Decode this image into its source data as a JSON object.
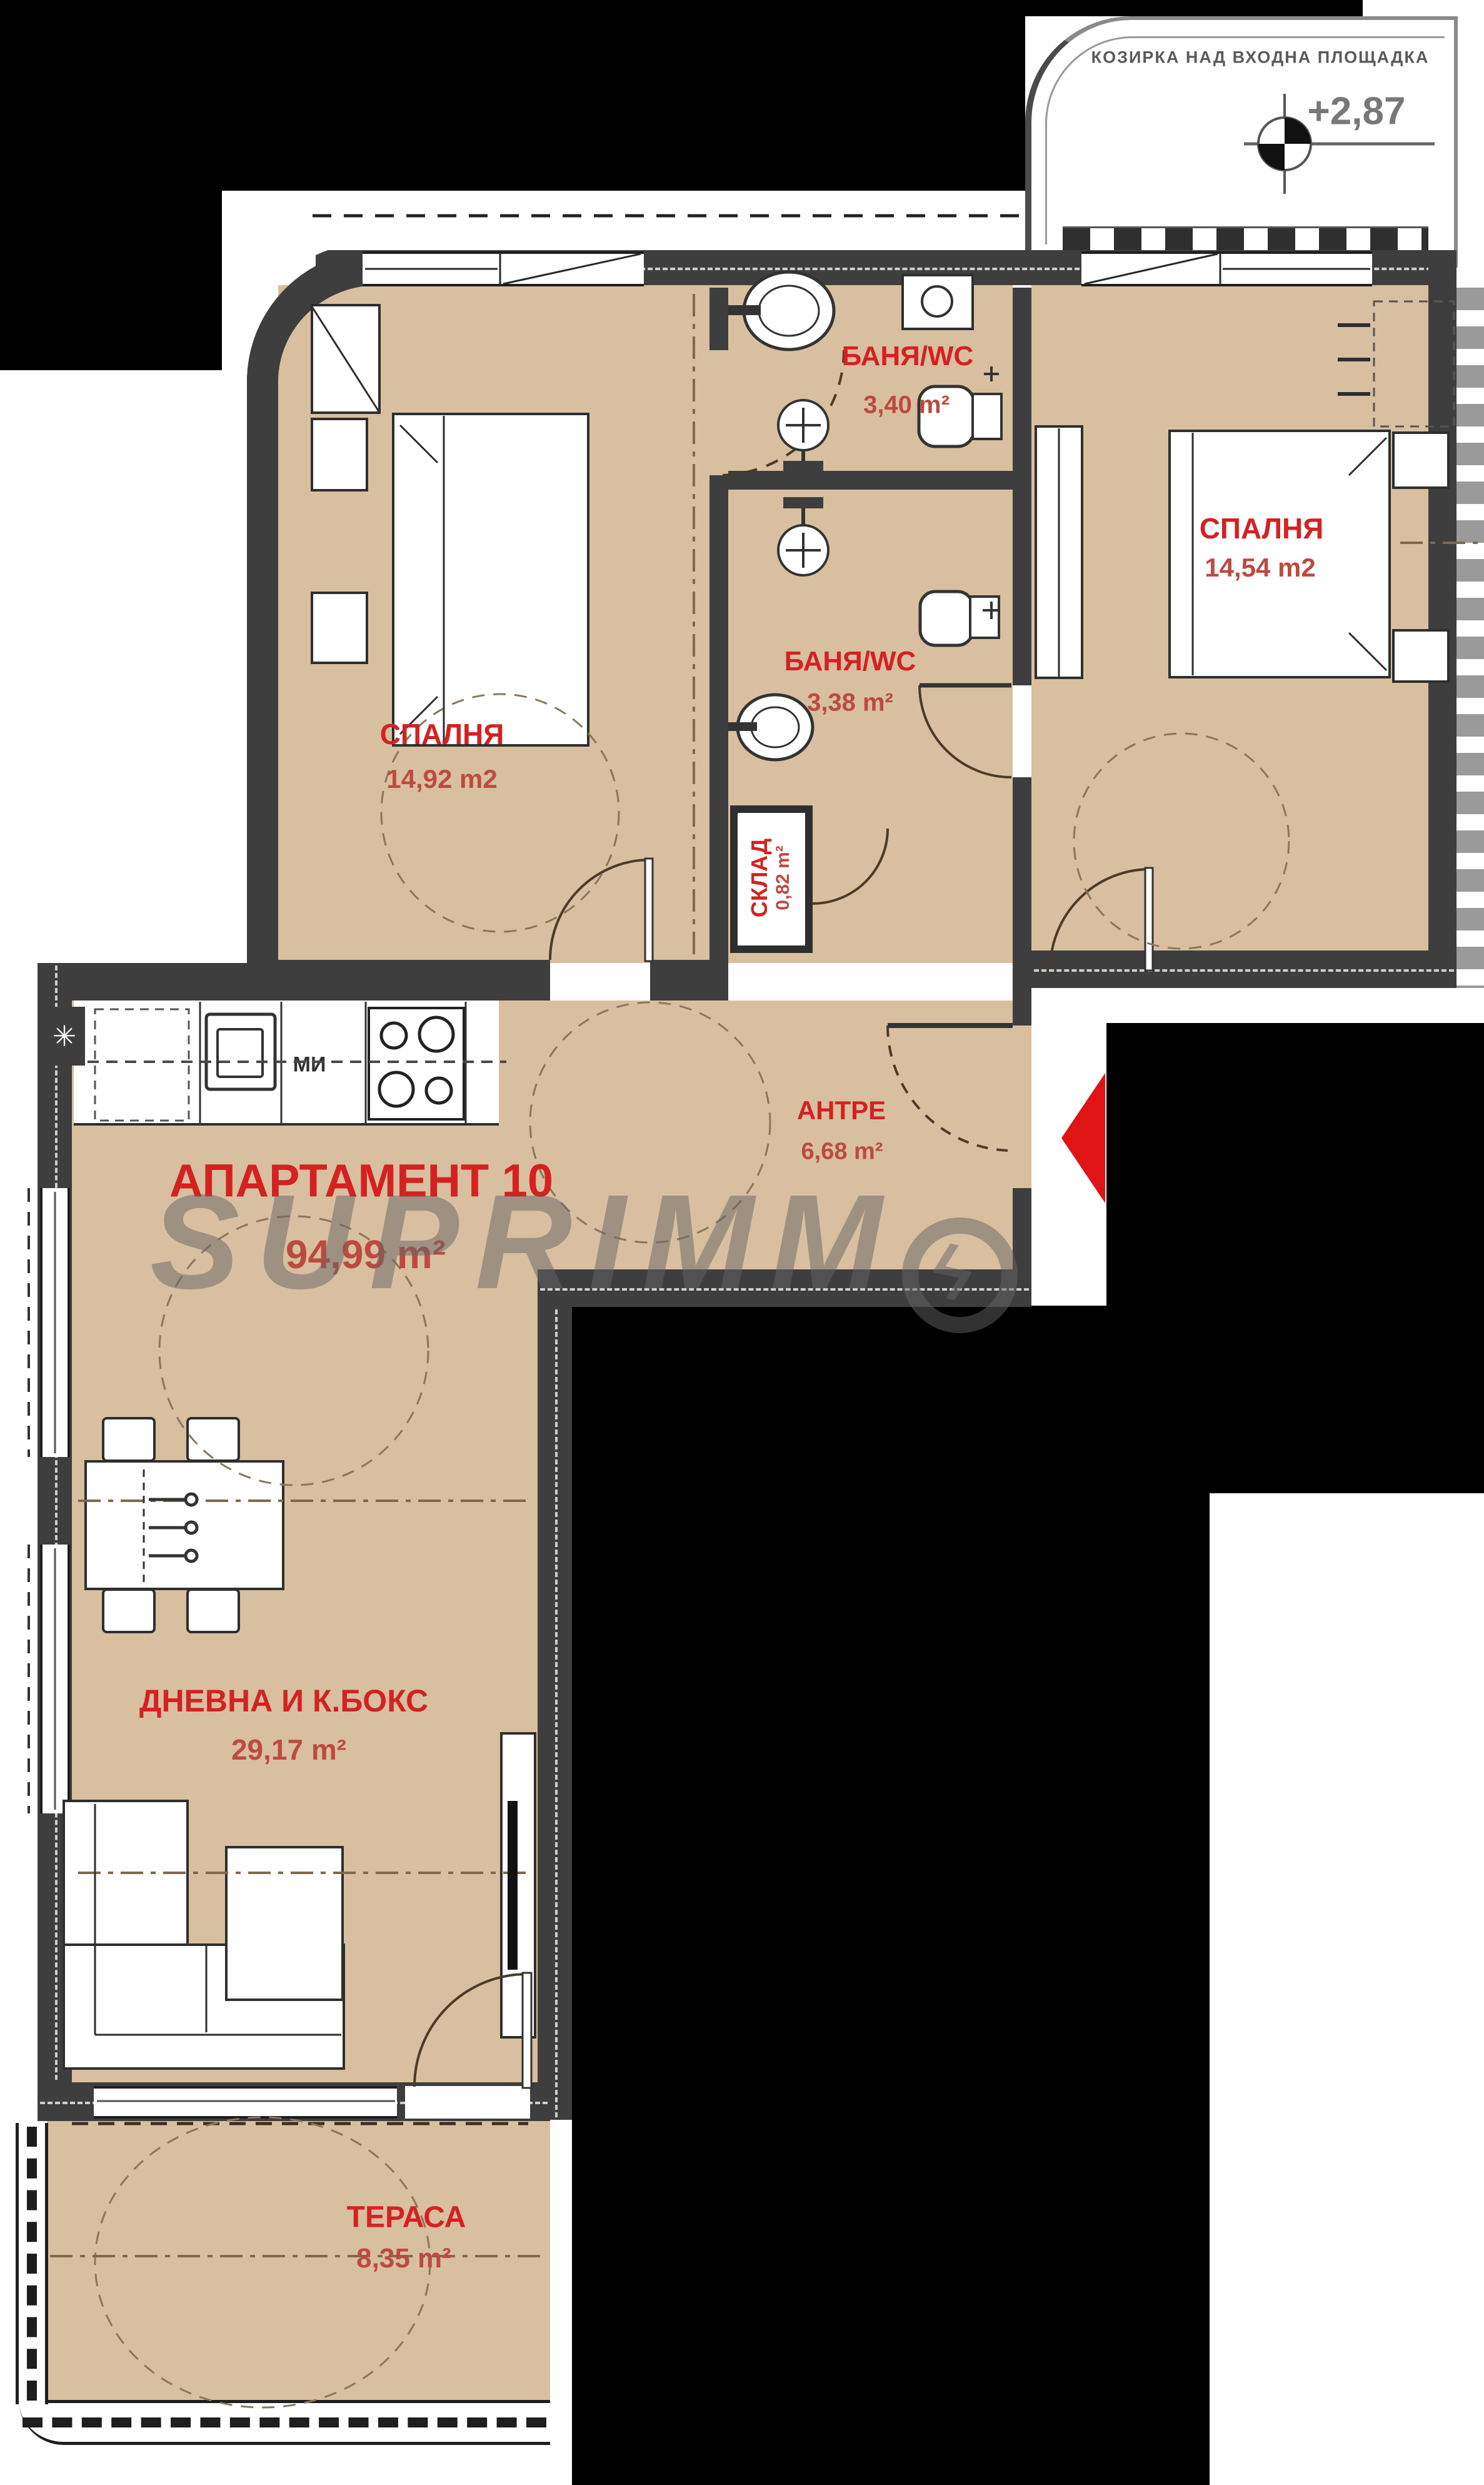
{
  "plan": {
    "watermark_text": "SUPRIMM",
    "watermark_bolt": "ϟ"
  },
  "canopy": {
    "label": "КОЗИРКА НАД ВХОДНА ПЛОЩАДКА",
    "elevation": "+2,87"
  },
  "apartment": {
    "name": "АПАРТАМЕНТ 10",
    "area": "94,99 m²"
  },
  "rooms": [
    {
      "id": "bedroom-left",
      "name": "СПАЛНЯ",
      "area": "14,92 m2"
    },
    {
      "id": "bedroom-right",
      "name": "СПАЛНЯ",
      "area": "14,54 m2"
    },
    {
      "id": "bath-top",
      "name": "БАНЯ/WC",
      "area": "3,40 m²"
    },
    {
      "id": "bath-bottom",
      "name": "БАНЯ/WC",
      "area": "3,38 m²"
    },
    {
      "id": "storage",
      "name": "СКЛАД",
      "area": "0,82 m²"
    },
    {
      "id": "hall",
      "name": "АНТРЕ",
      "area": "6,68 m²"
    },
    {
      "id": "living",
      "name": "ДНЕВНА И К.БОКС",
      "area": "29,17 m²"
    },
    {
      "id": "terrace",
      "name": "ТЕРАСА",
      "area": "8,35 m²"
    }
  ],
  "kitchen": {
    "appliance_label": "МИ",
    "corner_symbol": "✳"
  },
  "colors": {
    "floor": "#d8bfa0",
    "wall": "#3e3e3e",
    "room_label": "#d42121",
    "area_label": "#bd4a40",
    "arrow": "#e01414",
    "background": "#000000"
  }
}
